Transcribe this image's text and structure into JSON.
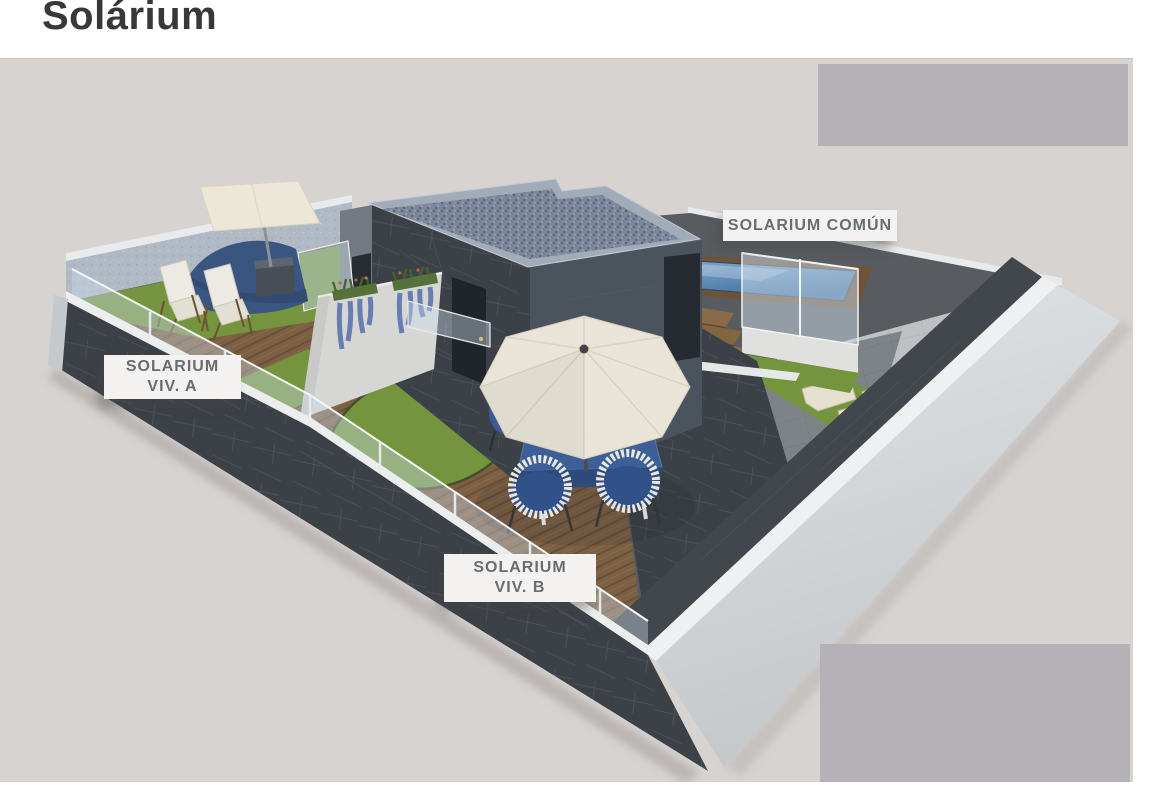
{
  "title": "Solárium",
  "labels": {
    "comun": {
      "line1": "SOLARIUM COMÚN"
    },
    "viv_a": {
      "line1": "SOLARIUM",
      "line2": "VIV. A"
    },
    "viv_b": {
      "line1": "SOLARIUM",
      "line2": "VIV. B"
    }
  },
  "scene": {
    "description": "Isometric 3D architectural render of a rooftop solarium: a shared pool terrace (solarium común) and two private terraces (viv. A and viv. B) with wooden decks, lawns, glass railings, a stair-tower with gravel flat roof, dining set with parasol, deck chairs, shade sail and cantilever canopy",
    "objects": [
      "stair-tower-building",
      "gravel-flat-roof",
      "swimming-pool",
      "wooden-pool-surround",
      "wooden-stairs",
      "glass-pool-screen",
      "sun-loungers",
      "lawn-areas",
      "wooden-decking",
      "dining-table-set",
      "center-parasol",
      "cantilever-canopy",
      "shade-sail",
      "planter-wall-with-flowers",
      "glass-perimeter-railing",
      "placeholder-blocks"
    ],
    "colors": {
      "background": "#d7d3d1",
      "placeholder_block": "#b4b1b7",
      "dark_wall": "#3f444a",
      "light_wall": "#dfe2e4",
      "rear_wall": "#b0b9c4",
      "wood_deck": "#7d6044",
      "grass": "#75943e",
      "pool_water": "#5d89b9",
      "parasol": "#e9e4d7",
      "furniture_blue": "#3c5f98",
      "label_bg": "#f3f2f0",
      "label_text": "#686d71",
      "title_text": "#38383a"
    }
  }
}
